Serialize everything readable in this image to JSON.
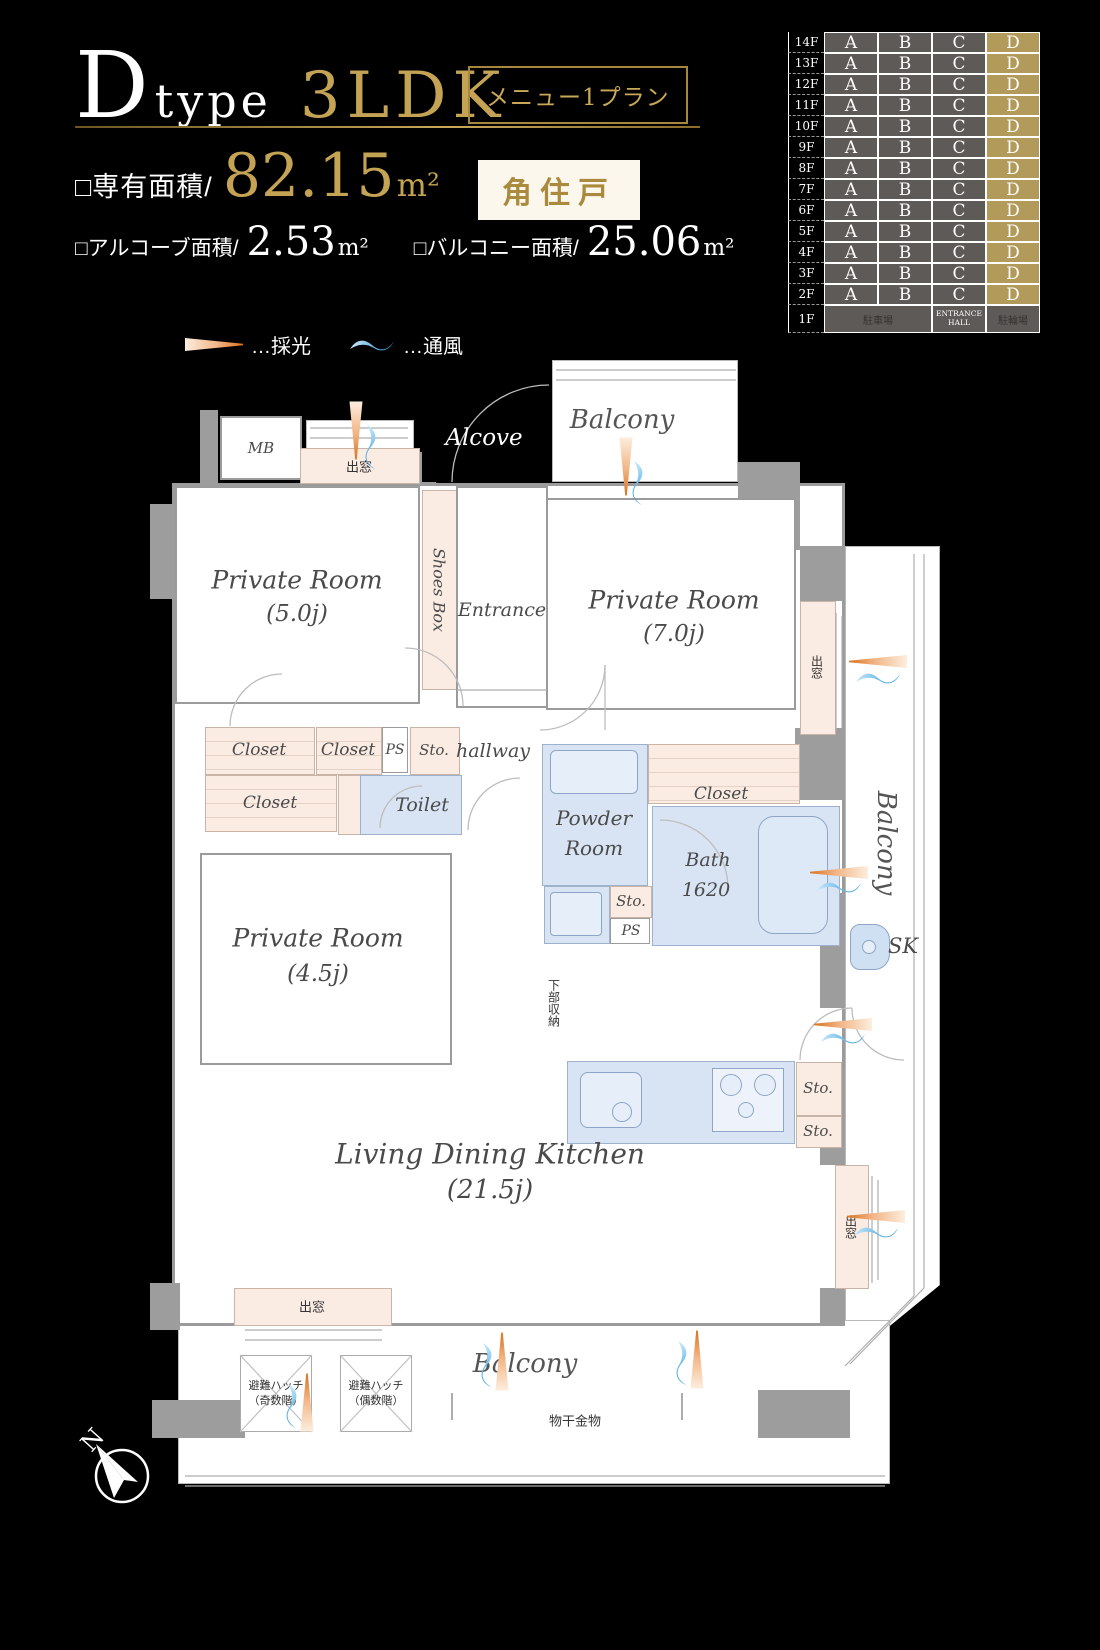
{
  "header": {
    "type_letter": "D",
    "type_word": "type",
    "plan_type": "3LDK",
    "menu_badge": "メニュー1プラン",
    "exclusive_area_label": "□専有面積/",
    "exclusive_area_value": "82.15",
    "unit": "m²",
    "corner_badge": "角住戸",
    "alcove_area_label": "□アルコーブ面積/",
    "alcove_area_value": "2.53",
    "balcony_area_label": "□バルコニー面積/",
    "balcony_area_value": "25.06"
  },
  "matrix": {
    "floors": [
      "14F",
      "13F",
      "12F",
      "11F",
      "10F",
      "9F",
      "8F",
      "7F",
      "6F",
      "5F",
      "4F",
      "3F",
      "2F"
    ],
    "units": [
      "A",
      "B",
      "C",
      "D"
    ],
    "highlight_unit": "D",
    "first_floor": {
      "label": "1F",
      "parking": "駐車場",
      "entrance": "ENTRANCE HALL",
      "bicycle": "駐輪場"
    }
  },
  "legend": {
    "daylight": "…採光",
    "ventilation": "…通風"
  },
  "plan": {
    "balcony_top": "Balcony",
    "alcove": "Alcove",
    "mb": "MB",
    "bay_window": "出窓",
    "shoes_box": "Shoes Box",
    "entrance": "Entrance",
    "room5_name": "Private Room",
    "room5_size": "(5.0j)",
    "room7_name": "Private Room",
    "room7_size": "(7.0j)",
    "closet": "Closet",
    "ps": "PS",
    "sto": "Sto.",
    "hallway": "hallway",
    "toilet": "Toilet",
    "powder_line1": "Powder",
    "powder_line2": "Room",
    "bath_line1": "Bath",
    "bath_line2": "1620",
    "balcony_right": "Balcony",
    "sk": "SK",
    "room45_name": "Private Room",
    "room45_size": "(4.5j)",
    "lower_storage": "下部収納",
    "ldk_name": "Living Dining Kitchen",
    "ldk_size": "(21.5j)",
    "sto_k": "Sto.",
    "hatch_odd_line1": "避難ハッチ",
    "hatch_odd_line2": "（奇数階）",
    "hatch_even_line1": "避難ハッチ",
    "hatch_even_line2": "（偶数階）",
    "balcony_bottom": "Balcony",
    "laundry": "物干金物",
    "compass_n": "N"
  },
  "colors": {
    "gold": "#c5a355",
    "matrix_cell": "#5d5a58",
    "matrix_highlight": "#b29a5b",
    "closet_pink": "#fbece3",
    "wet_blue": "#d8e4f3",
    "wall_gray": "#9d9d9d",
    "daylight_orange": "#d9731f",
    "ventilation_blue": "#2b9fe0"
  }
}
